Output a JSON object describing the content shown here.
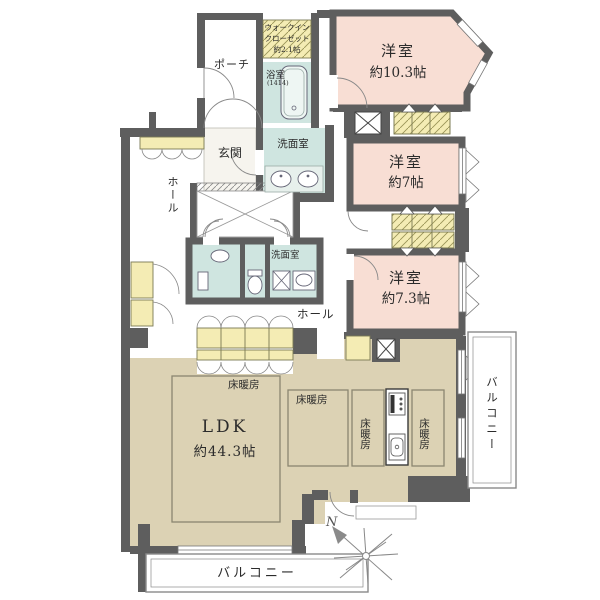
{
  "plan_title": "マンション間取り図",
  "labels": {
    "wic": {
      "line1": "ウォークイン",
      "line2": "クローゼット",
      "line3": "約2.1帖"
    },
    "bathroom": {
      "name": "浴室",
      "size": "(1414)"
    },
    "porch": {
      "name": "ポーチ"
    },
    "entrance": {
      "name": "玄関"
    },
    "washroom_upper": {
      "name": "洗面室"
    },
    "washroom_lower": {
      "name": "洗面室"
    },
    "hall_upper": {
      "name": "ホール"
    },
    "hall_lower": {
      "name": "ホール"
    },
    "bedroom1": {
      "name": "洋室",
      "size": "約10.3帖"
    },
    "bedroom2": {
      "name": "洋室",
      "size": "約7帖"
    },
    "bedroom3": {
      "name": "洋室",
      "size": "約7.3帖"
    },
    "ldk": {
      "name": "LDK",
      "size": "約44.3帖"
    },
    "floor_heating": "床暖房",
    "balcony_right": {
      "name": "バルコニー"
    },
    "balcony_bottom": {
      "name": "バルコニー"
    },
    "compass": {
      "north": "N"
    }
  },
  "colors": {
    "wall": "#5e5e5e",
    "bedroom_pink": "#f8ded4",
    "wet_area_teal": "#cfe5e0",
    "closet_yellow": "#f4ecb4",
    "ldk_tan": "#dcd2b4",
    "outline": "#777777"
  }
}
